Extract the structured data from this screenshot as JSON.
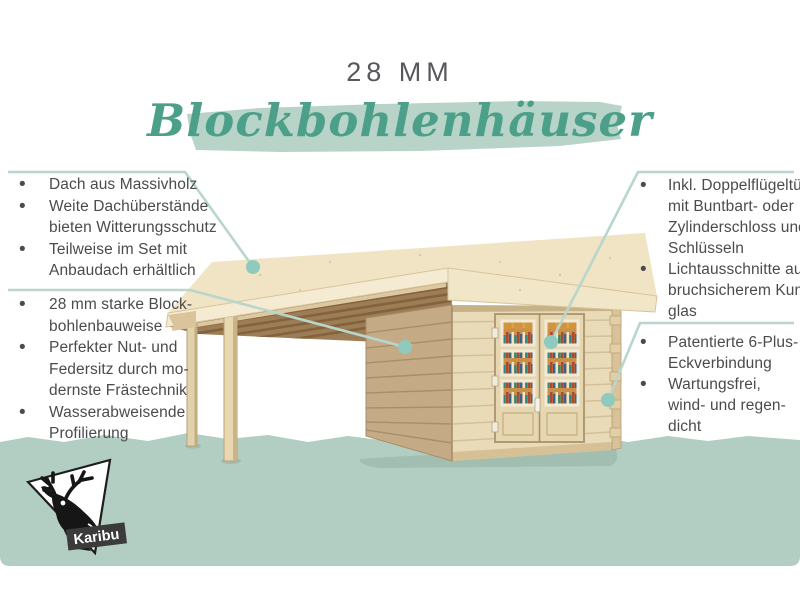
{
  "header": {
    "size_label": "28 MM",
    "title": "Blockbohlenhäuser"
  },
  "features": {
    "left_top": {
      "items": [
        {
          "lines": [
            "Dach aus Massivholz"
          ]
        },
        {
          "lines": [
            "Weite Dachüberstände",
            "bieten Witterungsschutz"
          ]
        },
        {
          "lines": [
            "Teilweise im Set mit",
            "Anbaudach erhältlich"
          ]
        }
      ]
    },
    "left_bottom": {
      "items": [
        {
          "lines": [
            "28 mm starke Block-",
            "bohlenbauweise"
          ]
        },
        {
          "lines": [
            "Perfekter Nut- und",
            "Federsitz durch mo-",
            "dernste Frästechnik"
          ]
        },
        {
          "lines": [
            "Wasserabweisende",
            "Profilierung"
          ]
        }
      ]
    },
    "right_top": {
      "items": [
        {
          "lines": [
            "Inkl. Doppelflügeltür",
            "mit Buntbart- oder",
            "Zylinderschloss und",
            "Schlüsseln"
          ]
        },
        {
          "lines": [
            "Lichtausschnitte aus",
            "bruchsicherem Kunst-",
            "glas"
          ]
        }
      ]
    },
    "right_bottom": {
      "items": [
        {
          "lines": [
            "Patentierte 6-Plus-",
            "Eckverbindung"
          ]
        },
        {
          "lines": [
            "Wartungsfrei,",
            "wind- und regen-",
            "dicht"
          ]
        }
      ]
    }
  },
  "logo": {
    "brand": "Karibu"
  },
  "colors": {
    "accent_teal": "#4c9f88",
    "brush_mint": "#b8d4c8",
    "callout_line": "#b9d6cc",
    "callout_dot": "#8ecabe",
    "ground_band": "#b2cdc1",
    "body_text": "#4a4b4d",
    "title_gray": "#57585c",
    "wood_light": "#e9dbb8",
    "wood_shadow": "#c4ab86",
    "roof_cream": "#f0e4c4"
  }
}
